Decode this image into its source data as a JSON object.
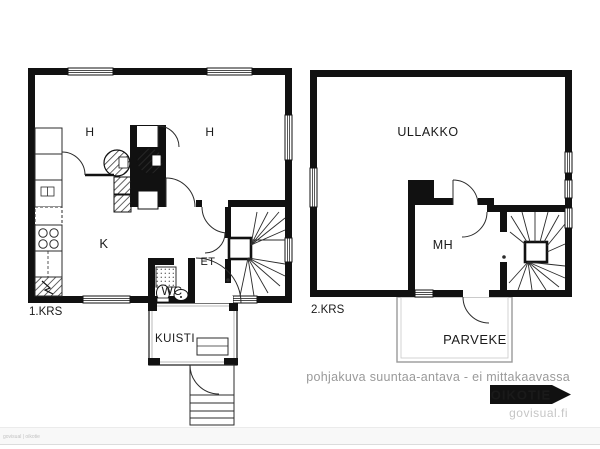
{
  "floor1": {
    "label": "1.KRS",
    "room_h_left": "H",
    "room_h_right": "H",
    "kitchen": "K",
    "hall": "ET",
    "wc": "WC",
    "porch": "KUISTI"
  },
  "floor2": {
    "label": "2.KRS",
    "attic": "ULLAKKO",
    "bedroom": "MH",
    "balcony": "PARVEKE"
  },
  "footer": {
    "disclaimer": "pohjakuva suuntaa-antava - ei mittakaavassa",
    "brand": "OIKOTIE",
    "site": "govisual.fi",
    "watermark": "govisual | oikotie"
  },
  "colors": {
    "wall": "#111111",
    "muted_text": "#9a9a9a",
    "brand_bg": "#111111",
    "brand_text": "#ffffff"
  }
}
